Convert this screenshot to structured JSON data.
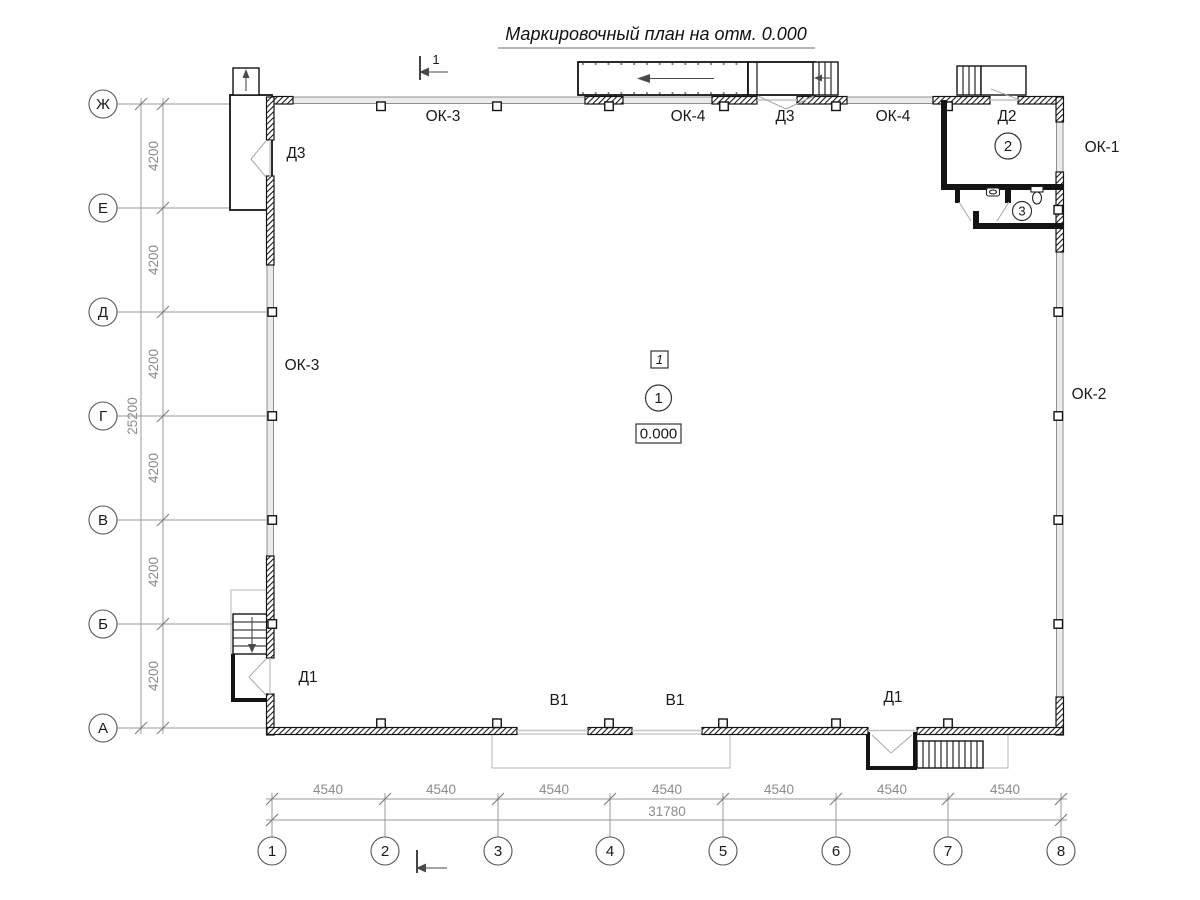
{
  "title": "Маркировочный план на отм. 0.000",
  "grid": {
    "rows": [
      "Ж",
      "Е",
      "Д",
      "Г",
      "В",
      "Б",
      "А"
    ],
    "cols": [
      "1",
      "2",
      "3",
      "4",
      "5",
      "6",
      "7",
      "8"
    ],
    "row_spacing_label": "4200",
    "row_total_label": "25200",
    "col_spacing_label": "4540",
    "col_total_label": "31780"
  },
  "section_mark": {
    "label": "1"
  },
  "marks": {
    "top_ok3": "ОК-3",
    "top_ok4_left": "ОК-4",
    "top_d3": "Д3",
    "top_ok4_right": "ОК-4",
    "top_d2": "Д2",
    "right_ok1": "ОК-1",
    "right_ok2": "ОК-2",
    "left_ok3": "ОК-3",
    "left_d3": "Д3",
    "left_d1": "Д1",
    "bottom_v1_left": "В1",
    "bottom_v1_right": "В1",
    "bottom_d1": "Д1"
  },
  "rooms": {
    "hall": {
      "type_tag": "1",
      "number": "1",
      "elevation": "0.000"
    },
    "room2": {
      "number": "2"
    },
    "room3": {
      "number": "3"
    }
  }
}
